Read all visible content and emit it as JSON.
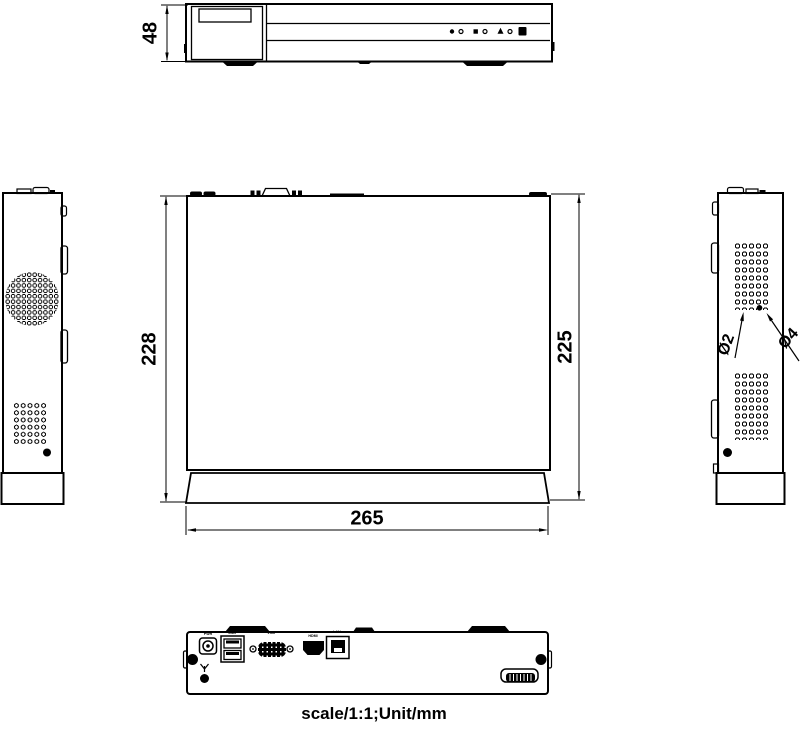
{
  "drawing": {
    "caption": "scale/1:1;Unit/mm",
    "dimensions": {
      "front_height": "48",
      "top_depth_overall": "228",
      "top_depth_body": "225",
      "top_width": "265",
      "vent_hole_small_dia": "Ø2",
      "vent_hole_large_dia": "Ø4"
    },
    "rear_panel": {
      "power_label": "PWR",
      "usb_label": "USB",
      "vga_label": "VGA",
      "hdmi_label": "HDMI",
      "lan_label": "LAN"
    },
    "colors": {
      "line": "#000000",
      "background": "#ffffff"
    }
  }
}
